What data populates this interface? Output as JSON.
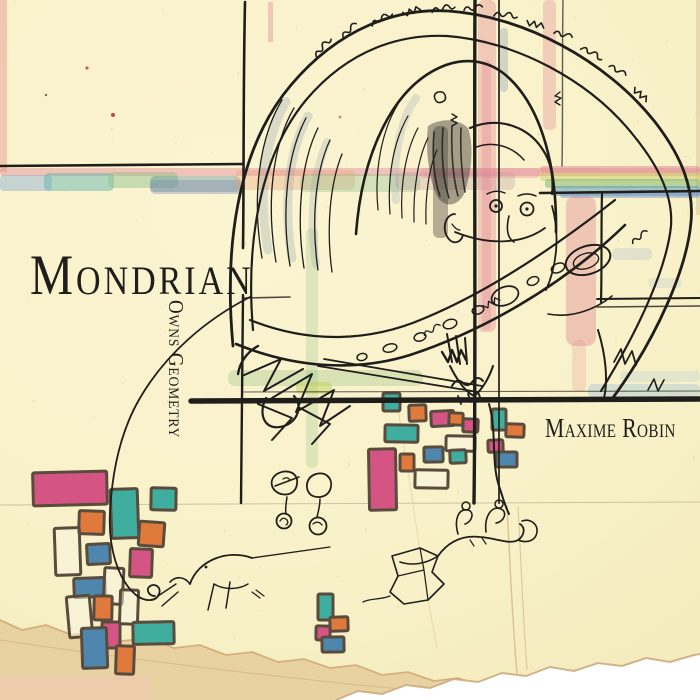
{
  "cover": {
    "title": "Mondrian",
    "subtitle": "Owns Geometry",
    "artist": "Maxime Robin"
  },
  "palette": {
    "paper": "#f8f1c8",
    "paper_shadow": "#e9d2a2",
    "ink": "#201e1b",
    "block_outline": "#5a4c3c",
    "pink": "#d45584",
    "teal": "#3fae9e",
    "orange": "#e0793c",
    "blue": "#4e86ad",
    "watercolor_pink": "#e28a98",
    "watercolor_green": "#8cc08b",
    "watercolor_blue": "#7aa5d6",
    "watercolor_teal": "#57b4ac",
    "watercolor_yellow": "#e3cf7b",
    "tear_white": "#ffffff"
  },
  "blocks": [
    {
      "x": 33,
      "y": 472,
      "w": 74,
      "h": 33,
      "fill": "pink",
      "rot": -1.5
    },
    {
      "x": 79,
      "y": 511,
      "w": 25,
      "h": 23,
      "fill": "orange",
      "rot": 2
    },
    {
      "x": 111,
      "y": 489,
      "w": 27,
      "h": 49,
      "fill": "teal",
      "rot": -2
    },
    {
      "x": 151,
      "y": 488,
      "w": 25,
      "h": 22,
      "fill": "teal",
      "rot": 1
    },
    {
      "x": 139,
      "y": 522,
      "w": 25,
      "h": 24,
      "fill": "orange",
      "rot": 4
    },
    {
      "x": 55,
      "y": 528,
      "w": 25,
      "h": 47,
      "fill": null,
      "rot": -2
    },
    {
      "x": 87,
      "y": 544,
      "w": 23,
      "h": 20,
      "fill": "blue",
      "rot": -3
    },
    {
      "x": 130,
      "y": 549,
      "w": 22,
      "h": 28,
      "fill": "pink",
      "rot": 2
    },
    {
      "x": 74,
      "y": 578,
      "w": 31,
      "h": 19,
      "fill": "blue",
      "rot": -2
    },
    {
      "x": 104,
      "y": 568,
      "w": 19,
      "h": 36,
      "fill": null,
      "rot": 3
    },
    {
      "x": 68,
      "y": 596,
      "w": 23,
      "h": 41,
      "fill": null,
      "rot": -5
    },
    {
      "x": 94,
      "y": 596,
      "w": 18,
      "h": 24,
      "fill": "orange",
      "rot": 1
    },
    {
      "x": 120,
      "y": 590,
      "w": 18,
      "h": 34,
      "fill": null,
      "rot": 2
    },
    {
      "x": 102,
      "y": 622,
      "w": 18,
      "h": 26,
      "fill": "pink",
      "rot": 0
    },
    {
      "x": 82,
      "y": 628,
      "w": 25,
      "h": 40,
      "fill": "blue",
      "rot": -2
    },
    {
      "x": 133,
      "y": 622,
      "w": 41,
      "h": 22,
      "fill": "teal",
      "rot": -1
    },
    {
      "x": 116,
      "y": 646,
      "w": 18,
      "h": 28,
      "fill": "orange",
      "rot": 2
    },
    {
      "x": 383,
      "y": 393,
      "w": 17,
      "h": 18,
      "fill": "teal",
      "rot": 0
    },
    {
      "x": 409,
      "y": 405,
      "w": 17,
      "h": 16,
      "fill": "orange",
      "rot": -2
    },
    {
      "x": 431,
      "y": 411,
      "w": 23,
      "h": 15,
      "fill": "pink",
      "rot": -3
    },
    {
      "x": 385,
      "y": 425,
      "w": 33,
      "h": 17,
      "fill": "teal",
      "rot": 1
    },
    {
      "x": 449,
      "y": 413,
      "w": 14,
      "h": 12,
      "fill": "orange",
      "rot": 2
    },
    {
      "x": 463,
      "y": 419,
      "w": 15,
      "h": 13,
      "fill": "pink",
      "rot": 2
    },
    {
      "x": 446,
      "y": 436,
      "w": 29,
      "h": 15,
      "fill": null,
      "rot": 1
    },
    {
      "x": 424,
      "y": 447,
      "w": 19,
      "h": 15,
      "fill": "blue",
      "rot": -1
    },
    {
      "x": 400,
      "y": 454,
      "w": 14,
      "h": 17,
      "fill": "orange",
      "rot": 0
    },
    {
      "x": 488,
      "y": 440,
      "w": 15,
      "h": 12,
      "fill": "pink",
      "rot": -2
    },
    {
      "x": 506,
      "y": 424,
      "w": 18,
      "h": 13,
      "fill": "orange",
      "rot": 2
    },
    {
      "x": 492,
      "y": 409,
      "w": 14,
      "h": 21,
      "fill": "teal",
      "rot": 0
    },
    {
      "x": 496,
      "y": 452,
      "w": 21,
      "h": 15,
      "fill": "blue",
      "rot": 0
    },
    {
      "x": 450,
      "y": 450,
      "w": 16,
      "h": 13,
      "fill": "teal",
      "rot": -2
    },
    {
      "x": 415,
      "y": 470,
      "w": 33,
      "h": 18,
      "fill": null,
      "rot": 1
    },
    {
      "x": 369,
      "y": 449,
      "w": 27,
      "h": 61,
      "fill": "pink",
      "rot": -1
    },
    {
      "x": 318,
      "y": 594,
      "w": 15,
      "h": 26,
      "fill": "teal",
      "rot": 0
    },
    {
      "x": 330,
      "y": 617,
      "w": 18,
      "h": 14,
      "fill": "orange",
      "rot": -2
    },
    {
      "x": 316,
      "y": 626,
      "w": 14,
      "h": 14,
      "fill": "pink",
      "rot": 1
    },
    {
      "x": 322,
      "y": 637,
      "w": 22,
      "h": 15,
      "fill": "blue",
      "rot": -1
    }
  ]
}
